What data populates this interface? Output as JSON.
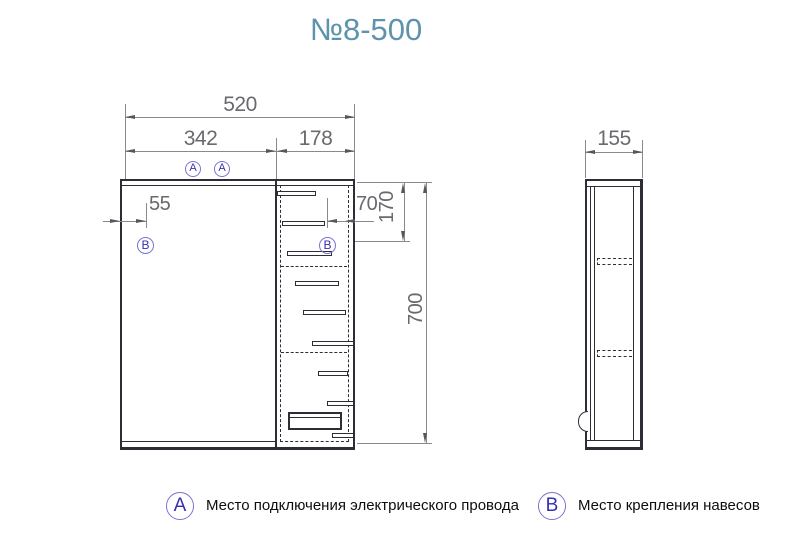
{
  "title": "№8-500",
  "colors": {
    "title_accent": "#5E93AD",
    "marker_ring": "#7A72D8",
    "marker_letter": "#372FB0",
    "dimension_text": "#6A6A6E",
    "drawing_line": "#2D2D35"
  },
  "front_view": {
    "dims": {
      "total_width": "520",
      "mirror_width": "342",
      "cabinet_width": "178",
      "bracket_left_offset": "55",
      "bracket_right_offset": "70",
      "bracket_top_offset": "170",
      "height": "700"
    }
  },
  "side_view": {
    "dims": {
      "depth": "155"
    }
  },
  "markers": {
    "a": "A",
    "b": "B"
  },
  "legend": {
    "a": {
      "letter": "A",
      "text": "Место подключения электрического провода"
    },
    "b": {
      "letter": "B",
      "text": "Место крепления навесов"
    }
  }
}
